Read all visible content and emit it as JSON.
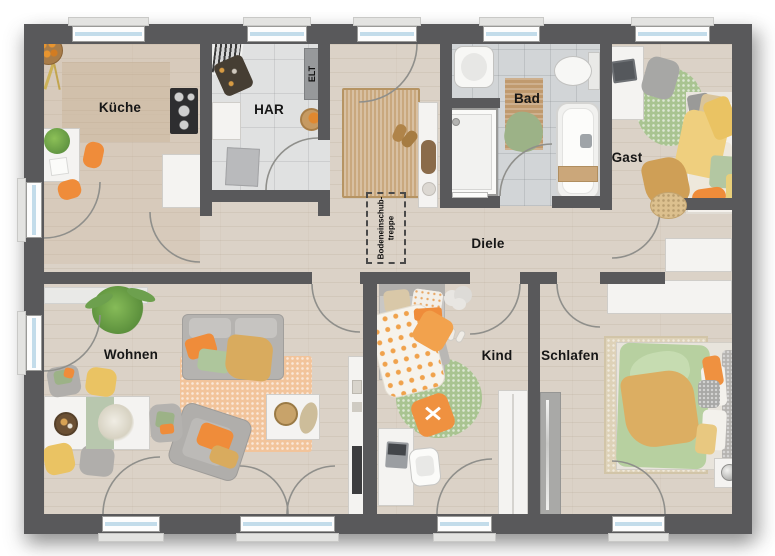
{
  "floorplan": {
    "title": "Bungalow Grundriss",
    "rooms": {
      "kueche": {
        "label": "Küche"
      },
      "har": {
        "label": "HAR"
      },
      "bad": {
        "label": "Bad"
      },
      "gast": {
        "label": "Gast"
      },
      "diele": {
        "label": "Diele"
      },
      "wohnen": {
        "label": "Wohnen"
      },
      "kind": {
        "label": "Kind"
      },
      "schlafen": {
        "label": "Schlafen"
      }
    },
    "annotations": {
      "elt": "ELT",
      "attic_line1": "Bodeneinschub-",
      "attic_line2": "treppe"
    },
    "colors": {
      "wall": "#59595b",
      "wood": "#dbd2c7",
      "tile_har": "#e0e1e1",
      "tile_bad": "#d2d5d7",
      "glass": "#c3dcea",
      "orange": "#ef8c3a",
      "yellow": "#eac363",
      "mustard": "#d9ab5e",
      "green": "#a9c491",
      "salmon": "#f2c49b",
      "jute": "#c9a87e"
    }
  }
}
